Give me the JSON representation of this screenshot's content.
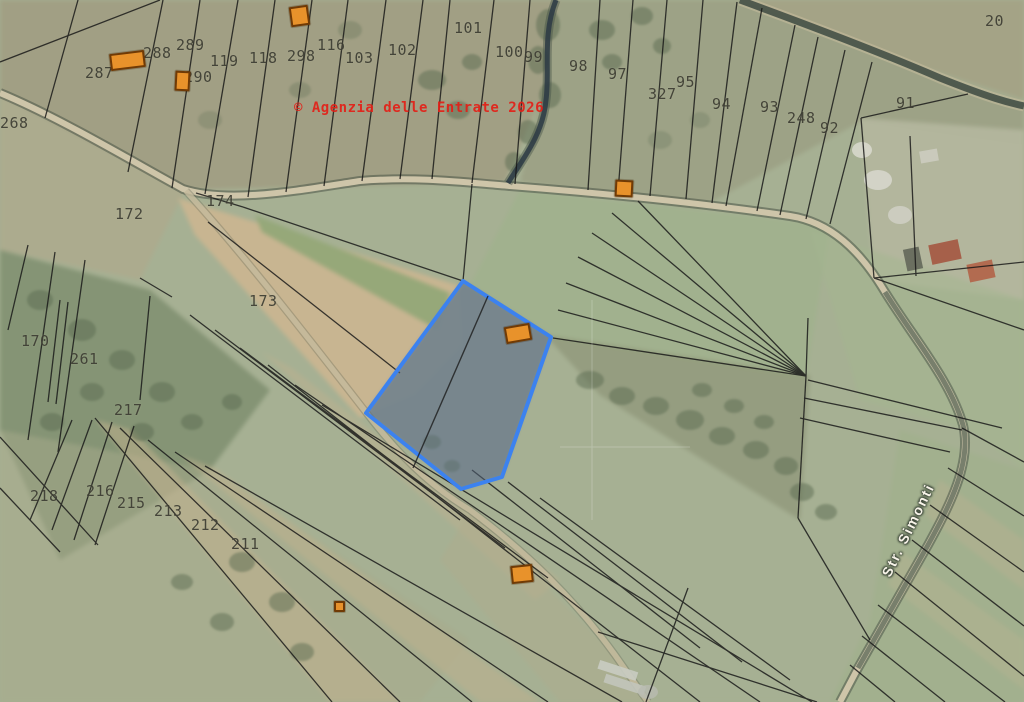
{
  "map": {
    "watermark": "© Agenzia delle Entrate 2026",
    "street_label": "Str. Simonti",
    "colors": {
      "selected_stroke": "#3c82ef",
      "selected_fill": "rgba(96,116,140,0.45)",
      "building_fill": "#e8922b",
      "watermark_red": "#e41f17",
      "boundary_black": "#161616"
    },
    "selected_parcel": {
      "polygon": [
        [
          463,
          281
        ],
        [
          551,
          337
        ],
        [
          502,
          477
        ],
        [
          461,
          489
        ],
        [
          366,
          413
        ]
      ],
      "divider": [
        [
          488,
          296
        ],
        [
          413,
          468
        ]
      ]
    },
    "parcel_labels": [
      {
        "text": "287",
        "x": 85,
        "y": 64
      },
      {
        "text": "288",
        "x": 143,
        "y": 44
      },
      {
        "text": "289",
        "x": 176,
        "y": 36
      },
      {
        "text": "290",
        "x": 184,
        "y": 68
      },
      {
        "text": "119",
        "x": 210,
        "y": 52
      },
      {
        "text": "118",
        "x": 249,
        "y": 49
      },
      {
        "text": "298",
        "x": 287,
        "y": 47
      },
      {
        "text": "116",
        "x": 317,
        "y": 36
      },
      {
        "text": "103",
        "x": 345,
        "y": 49
      },
      {
        "text": "102",
        "x": 388,
        "y": 41
      },
      {
        "text": "101",
        "x": 454,
        "y": 19
      },
      {
        "text": "100",
        "x": 495,
        "y": 43
      },
      {
        "text": "99",
        "x": 524,
        "y": 48
      },
      {
        "text": "98",
        "x": 569,
        "y": 57
      },
      {
        "text": "97",
        "x": 608,
        "y": 65
      },
      {
        "text": "327",
        "x": 648,
        "y": 85
      },
      {
        "text": "95",
        "x": 676,
        "y": 73
      },
      {
        "text": "94",
        "x": 712,
        "y": 95
      },
      {
        "text": "93",
        "x": 760,
        "y": 98
      },
      {
        "text": "248",
        "x": 787,
        "y": 109
      },
      {
        "text": "92",
        "x": 820,
        "y": 119
      },
      {
        "text": "91",
        "x": 896,
        "y": 94
      },
      {
        "text": "20",
        "x": 985,
        "y": 12
      },
      {
        "text": "268",
        "x": 0,
        "y": 114
      },
      {
        "text": "172",
        "x": 115,
        "y": 205
      },
      {
        "text": "174",
        "x": 206,
        "y": 192
      },
      {
        "text": "173",
        "x": 249,
        "y": 292
      },
      {
        "text": "170",
        "x": 21,
        "y": 332
      },
      {
        "text": "261",
        "x": 70,
        "y": 350
      },
      {
        "text": "217",
        "x": 114,
        "y": 401
      },
      {
        "text": "218",
        "x": 30,
        "y": 487
      },
      {
        "text": "216",
        "x": 86,
        "y": 482
      },
      {
        "text": "215",
        "x": 117,
        "y": 494
      },
      {
        "text": "213",
        "x": 154,
        "y": 502
      },
      {
        "text": "212",
        "x": 191,
        "y": 516
      },
      {
        "text": "211",
        "x": 231,
        "y": 535
      }
    ],
    "buildings": [
      {
        "x": 110,
        "y": 52,
        "w": 31,
        "h": 13,
        "rot": -7
      },
      {
        "x": 175,
        "y": 71,
        "w": 11,
        "h": 16,
        "rot": 3
      },
      {
        "x": 290,
        "y": 6,
        "w": 15,
        "h": 16,
        "rot": -8
      },
      {
        "x": 615,
        "y": 180,
        "w": 14,
        "h": 13,
        "rot": 3
      },
      {
        "x": 505,
        "y": 325,
        "w": 22,
        "h": 13,
        "rot": -10
      },
      {
        "x": 511,
        "y": 565,
        "w": 18,
        "h": 14,
        "rot": -6
      },
      {
        "x": 334,
        "y": 601,
        "w": 7,
        "h": 7,
        "rot": 0
      }
    ]
  }
}
